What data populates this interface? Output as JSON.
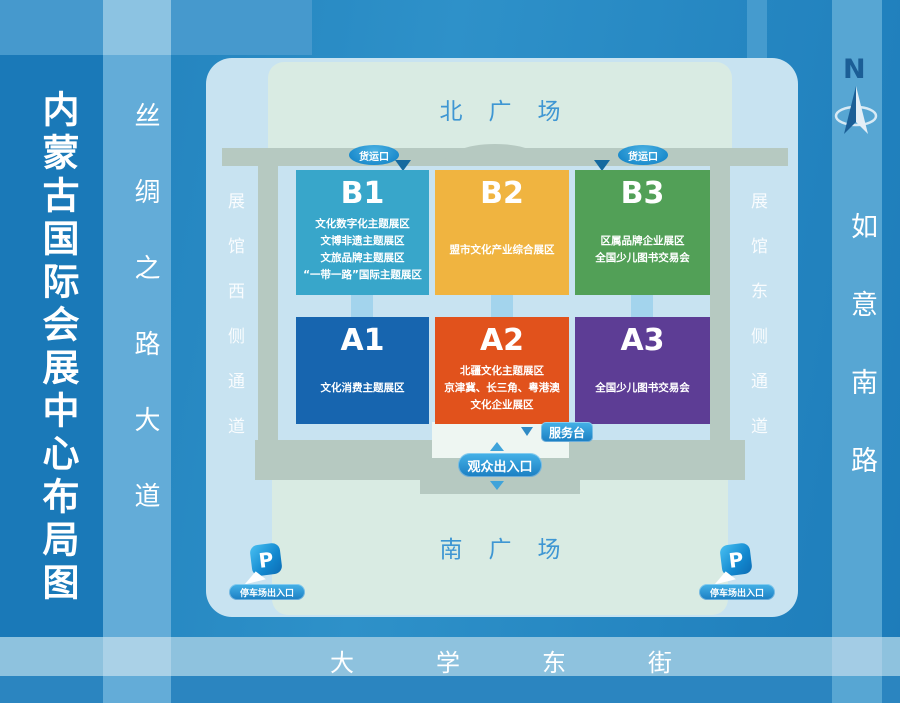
{
  "page_title": "内蒙古国际会展中心布局图",
  "roads": {
    "silk_road": "丝绸之路大道",
    "ruyi_south_road": "如意南路",
    "university_east_street": "大学东街"
  },
  "plazas": {
    "north": "北广场",
    "south": "南广场"
  },
  "passages": {
    "west": "展馆西侧通道",
    "east": "展馆东侧通道"
  },
  "compass": {
    "north_label": "N"
  },
  "labels": {
    "freight_entrance": "货运口",
    "service_desk": "服务台",
    "visitor_entrance": "观众出入口",
    "parking_entrance": "停车场出入口",
    "parking_symbol": "P"
  },
  "halls": {
    "b1": {
      "id": "B1",
      "color": "#38a6ca",
      "lines": [
        "文化数字化主题展区",
        "文博非遗主题展区",
        "文旅品牌主题展区",
        "“一带一路”国际主题展区"
      ]
    },
    "b2": {
      "id": "B2",
      "color": "#f0b440",
      "lines": [
        "盟市文化产业综合展区"
      ]
    },
    "b3": {
      "id": "B3",
      "color": "#52a057",
      "lines": [
        "区属品牌企业展区",
        "全国少儿图书交易会"
      ]
    },
    "a1": {
      "id": "A1",
      "color": "#1765af",
      "lines": [
        "文化消费主题展区"
      ]
    },
    "a2": {
      "id": "A2",
      "color": "#e1521c",
      "lines": [
        "北疆文化主题展区",
        "京津冀、长三角、粤港澳",
        "文化企业展区"
      ]
    },
    "a3": {
      "id": "A3",
      "color": "#5d3d95",
      "lines": [
        "全国少儿图书交易会"
      ]
    }
  },
  "colors": {
    "map_background": "#c8e3f1",
    "plaza_background": "#d9ebe3",
    "building_gray": "#b6c9c1",
    "badge_blue": "#1f8ccd",
    "plaza_text_blue": "#3e96d3",
    "compass_navy": "#1b5e96",
    "road_light_blue": "#63acd8"
  }
}
